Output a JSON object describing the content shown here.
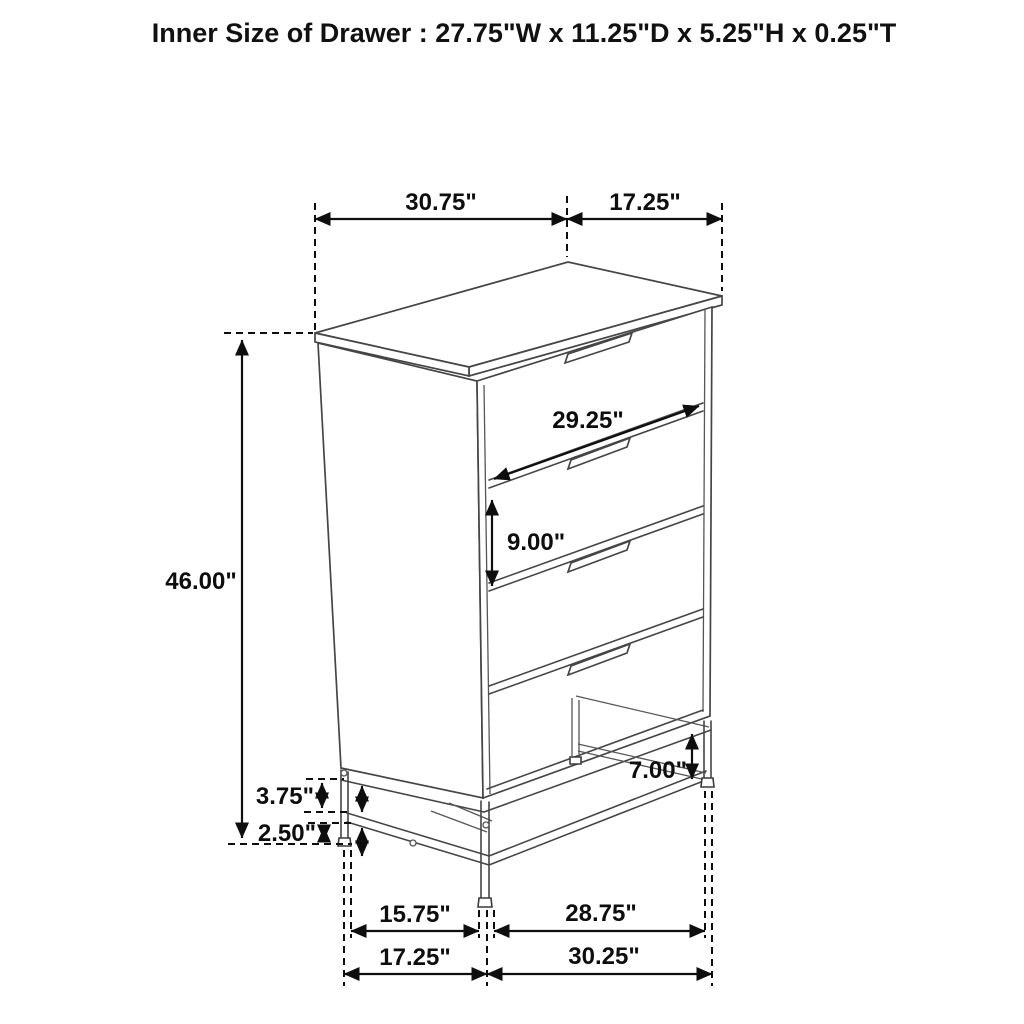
{
  "title": "Inner Size of Drawer : 27.75\"W x 11.25\"D x 5.25\"H x 0.25\"T",
  "diagram": {
    "object": "four-drawer chest on metal base frame",
    "drawer_count": 4,
    "inner_drawer_size": {
      "width": "27.75\"",
      "depth": "11.25\"",
      "height": "5.25\"",
      "thickness": "0.25\""
    }
  },
  "dims": {
    "top_width": "30.75\"",
    "top_depth": "17.25\"",
    "height": "46.00\"",
    "drawer_width": "29.25\"",
    "drawer_height": "9.00\"",
    "base_clearance": "3.75\"",
    "stretcher_to_floor": "2.50\"",
    "leg_height": "7.00\"",
    "leg_span_depth": "15.75\"",
    "leg_span_width": "28.75\"",
    "base_depth": "17.25\"",
    "base_width": "30.25\""
  }
}
